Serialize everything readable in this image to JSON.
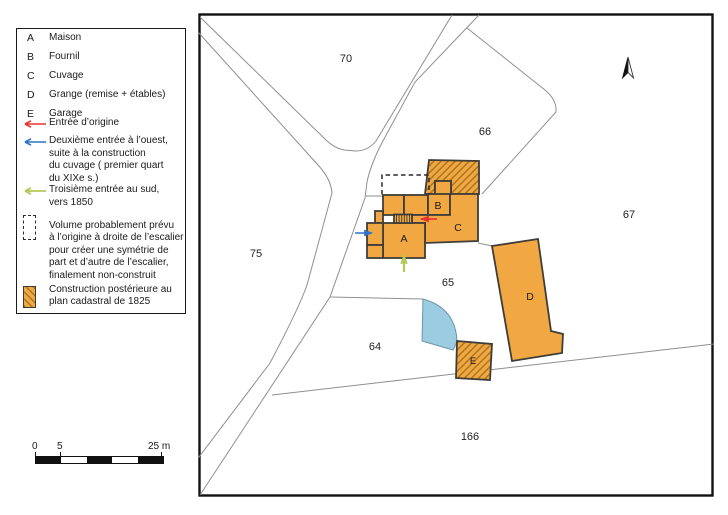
{
  "legend": {
    "buildings": [
      {
        "key": "A",
        "label": "Maison"
      },
      {
        "key": "B",
        "label": "Fournil"
      },
      {
        "key": "C",
        "label": "Cuvage"
      },
      {
        "key": "D",
        "label": "Grange (remise + étables)"
      },
      {
        "key": "E",
        "label": "Garage"
      }
    ],
    "entries": [
      {
        "icon": "red-arrow",
        "lines": [
          "Entrée d’origine"
        ]
      },
      {
        "icon": "blue-arrow",
        "lines": [
          "Deuxième entrée à l’ouest,",
          "suite à la construction",
          "du cuvage ( premier quart",
          "du XIXe s.)"
        ]
      },
      {
        "icon": "green-arrow",
        "lines": [
          "Troisième entrée au sud,",
          "vers 1850"
        ]
      },
      {
        "icon": "dashed-box",
        "lines": [
          "Volume probablement prévu",
          "à l’origine à droite de l’escalier",
          "pour créer une symétrie de",
          "part et d’autre de l’escalier,",
          "finalement non-construit"
        ]
      },
      {
        "icon": "hatched-box",
        "lines": [
          "Construction postérieure au",
          "plan cadastral de 1825"
        ]
      }
    ]
  },
  "scalebar": {
    "tick0": "0",
    "tick5": "5",
    "tick25": "25 m"
  },
  "map": {
    "parcels": [
      "70",
      "66",
      "67",
      "75",
      "65",
      "64",
      "166"
    ],
    "buildings": [
      "A",
      "B",
      "C",
      "D",
      "E"
    ]
  },
  "colors": {
    "building_fill": "#F1A843",
    "hatch_line": "#A9761F",
    "pond_blue": "#9BCCE1",
    "arrow_red": "#E5332E",
    "arrow_blue": "#2F72C8",
    "arrow_green": "#B5C95A"
  }
}
